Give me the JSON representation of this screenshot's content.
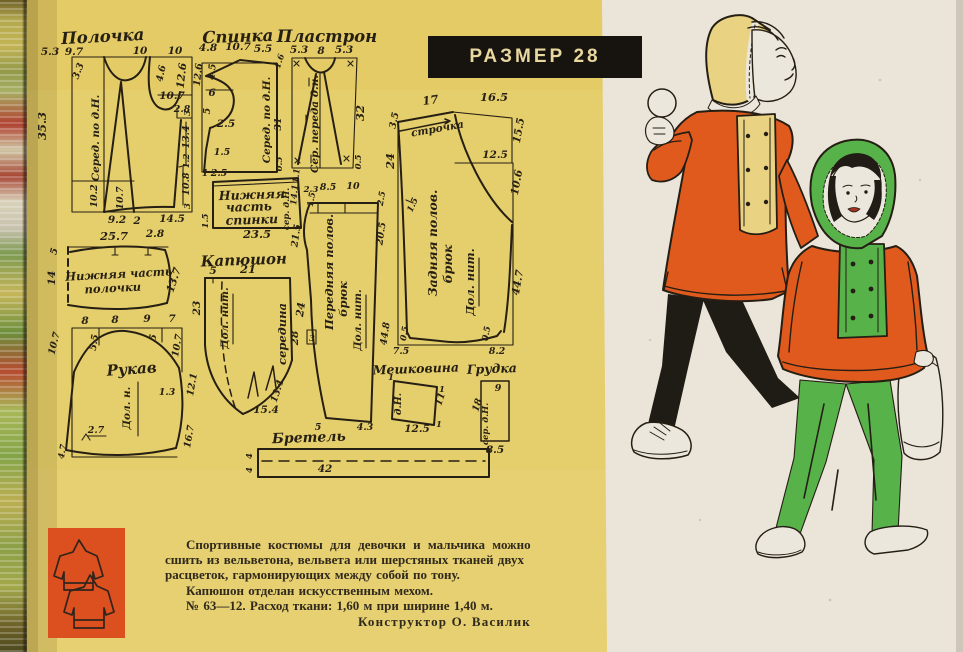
{
  "banner": {
    "label": "РАЗМЕР 28"
  },
  "colors": {
    "page_yellow": "#e5ce6c",
    "paper_white": "#eae4d9",
    "ink": "#261f13",
    "jacket_orange": "#e05a1d",
    "suit_green": "#58b24a",
    "hood_yellow": "#e9d383",
    "banner_bg": "#17140f",
    "banner_text": "#e8d79e",
    "icon_block_orange": "#dc4f1e"
  },
  "patterns": {
    "polochka": {
      "title": "Полочка",
      "top": [
        "5.3",
        "9.7",
        "10",
        "10"
      ],
      "neck": "3.3",
      "side": "35.3",
      "grain": "Серед. по д.Н.",
      "hem1": "10.2",
      "hem2": "10.7",
      "arm1": "4.6",
      "arm2": "12.6",
      "arm3": "10.7",
      "arm4": "2.8",
      "r1": "3",
      "r2": "13.4",
      "r3": "1.2",
      "r4": "10.8",
      "r5": "3",
      "bottom": [
        "9.2",
        "2",
        "14.5"
      ]
    },
    "spinka": {
      "title": "Спинка",
      "top": [
        "4.8",
        "10.7",
        "5.5"
      ],
      "l1": "12.6",
      "l2": "4.5",
      "l3": "6",
      "l4": "5",
      "l5": "2.5",
      "l6": "1.5",
      "grain": "Серед. по д.Н.",
      "r1": "1.6",
      "r2": "31",
      "r3": "0.5"
    },
    "plastron": {
      "title": "Пластрон",
      "top": [
        "5.3",
        "8",
        "5.3"
      ],
      "grain": "Сер. переда д.н.",
      "r1": "32",
      "r2": "0.5"
    },
    "nizh_spinki": {
      "title_lines": [
        "Нижняя",
        "часть",
        "спинки"
      ],
      "t1": "1",
      "t2": "2.5",
      "left": "1.5",
      "bottom": "23.5",
      "grain": "сер. д.Н.",
      "r1": "14.1",
      "r2": "1.1"
    },
    "nizh_polochki": {
      "title_lines": [
        "Нижняя часть",
        "полочки"
      ],
      "top1": "25.7",
      "top2": "2.8",
      "l1": "5",
      "l2": "14",
      "r": "13.7"
    },
    "kapyushon": {
      "title": "Капюшон",
      "t1": "5",
      "t2": "21",
      "left": "23",
      "grain": "Дол. нит.",
      "middle": "середина",
      "right": "28",
      "b1": "13.4",
      "b2": "15.4"
    },
    "rukav": {
      "title": "Рукав",
      "top": [
        "8",
        "8",
        "9",
        "7"
      ],
      "l1": "10.7",
      "l2": "5.5",
      "r1": "5",
      "r2": "10.7",
      "r3": "12.1",
      "r4": "1.3",
      "r5": "16.7",
      "b1": "2.7",
      "b2": "4.7",
      "grain": "Дол. н."
    },
    "pered_bryuk": {
      "title_lines": [
        "Передняя полов.",
        "брюк"
      ],
      "grain": "Дол. нит.",
      "top": [
        "2.3",
        "8.5",
        "10"
      ],
      "t1": "1.5",
      "t2": "2.5",
      "l1": "21.5",
      "l2": "24",
      "l3": "3",
      "r1": "20.5",
      "r2": "44.8",
      "b1": "5",
      "b2": "4.3"
    },
    "zad_bryuk": {
      "title_lines": [
        "Задняя полов.",
        "брюк"
      ],
      "grain": "Дол. нит.",
      "stitch": "строчка",
      "top1": "17",
      "top2": "16.5",
      "l1": "3.5",
      "l2": "24",
      "l3": "1.5",
      "r1": "15.5",
      "r2": "12.5",
      "r3": "10.6",
      "r4": "44.7",
      "b1": "0.5",
      "b2": "0.5",
      "b3": "7.5",
      "b4": "8.2"
    },
    "meshkovina": {
      "title": "Мешковина",
      "grain": "д.Н.",
      "r": "11",
      "b": "12.5",
      "k1": "1",
      "k2": "1",
      "k3": "1"
    },
    "grudka": {
      "title": "Грудка",
      "top": "9",
      "left": "18",
      "grain": "сер. д.Н.",
      "bottom": "8.5"
    },
    "bretel": {
      "title": "Бретель",
      "l1": "4",
      "l2": "4",
      "c": "42"
    }
  },
  "footer": {
    "line1": "Спортивные костюмы для девочки и мальчика можно",
    "line2": "сшить из вельветона, вельвета или шерстяных тканей двух",
    "line3": "расцветок, гармонирующих между собой по тону.",
    "line4": "Капюшон отделан искусственным мехом.",
    "line5": "№ 63—12. Расход ткани: 1,60 м при ширине 1,40 м.",
    "signature": "Конструктор О. Василик"
  }
}
